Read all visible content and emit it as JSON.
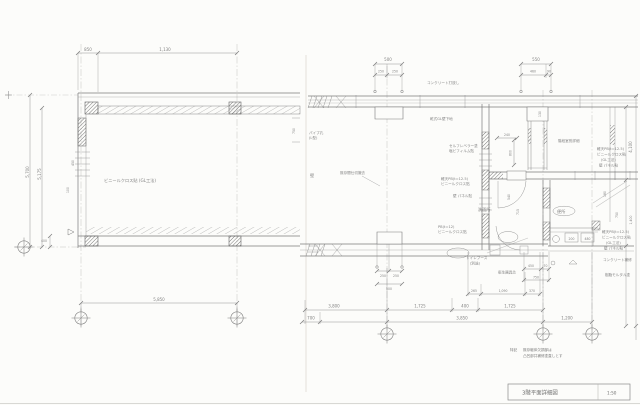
{
  "title_block": {
    "title": "3階平面詳細図",
    "scale": "1:50"
  },
  "note": {
    "head": "特記",
    "line1": "既存躯体欠損部は",
    "line2": "凸凹部共補修塗直しとす"
  },
  "left_plan": {
    "labels": {
      "finish": "ビニールクロス貼 (GL工法)"
    },
    "dims": {
      "top1": "850",
      "top2": "1,130",
      "v1": "5,700",
      "v2": "5,175",
      "s400": "400",
      "s450": "450",
      "s100": "100",
      "bottom": "5,850",
      "r750": "750"
    }
  },
  "right_plan": {
    "labels": {
      "concrete": "コンクリート打放し",
      "dry_wall": "乾式GL壁下地",
      "pipe1": "パイプ孔",
      "pipe2": "(L型)",
      "wall_char": "壁",
      "demolish": "既存間仕切撤去",
      "self_level1": "セルフレベラー塗",
      "self_level2": "塩ビフィルム貼",
      "keiten1": "軽天PB(t=12.5)",
      "keiten2": "ビニールクロス貼",
      "panel": "壁 パネル貼",
      "pb1": "PB(t=12)",
      "pb2": "ビニールクロス貼",
      "washroom": "洗面所",
      "toilet": "便所",
      "stair": "階段室別詳細",
      "note_r1": "軽天PB(t=12.5)",
      "note_r2": "ビニールクロス貼",
      "note_r3": "(GL工法)",
      "note_r4": "壁 パネル貼",
      "conc_repair": "コンクリート補修",
      "mortar": "樹脂モルタル塗",
      "booth1": "トイレブース",
      "booth2": "(別途)",
      "fixture": "衛生器具芯"
    },
    "dims": {
      "t500": "500",
      "t250a": "250",
      "t250b": "250",
      "t550": "550",
      "t460": "460",
      "t90": "90",
      "d240": "240",
      "d800": "800",
      "d130": "130",
      "d715": "715",
      "d540": "540",
      "d180": "180",
      "r4100": "4,100",
      "r750": "750",
      "r1400": "1,400",
      "w200": "200",
      "w480": "480",
      "b250a": "250",
      "b250b": "250",
      "b500": "500",
      "m265": "265",
      "m1090": "1,090",
      "m370": "370",
      "m450": "450",
      "m70": "70",
      "m750": "750",
      "row1a": "3,800",
      "row1b": "1,725",
      "row1c": "400",
      "row1d": "1,725",
      "row2a": "700",
      "row2b": "3,850",
      "row2c": "1,200"
    }
  }
}
